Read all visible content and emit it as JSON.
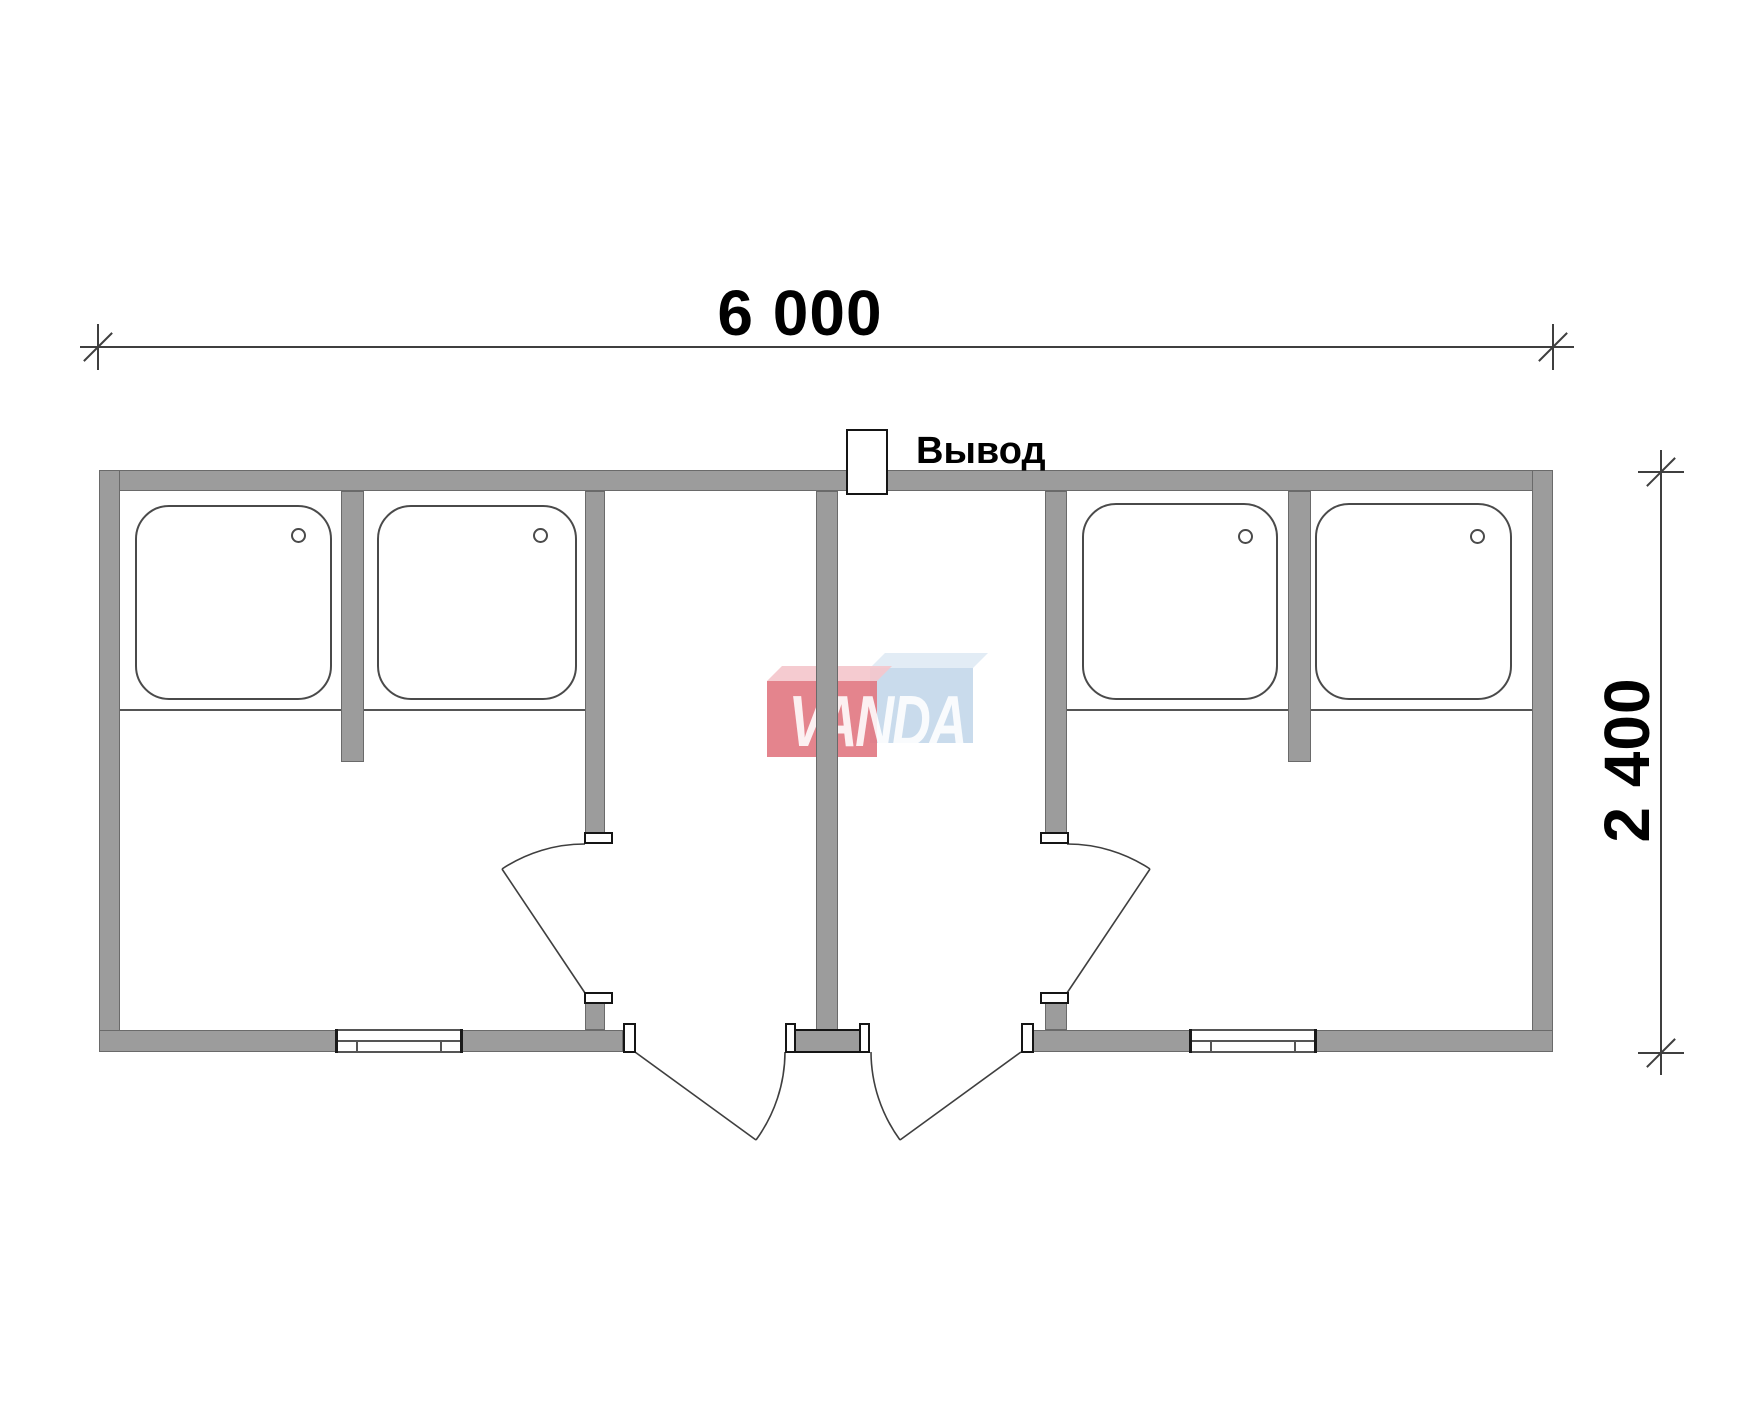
{
  "dimensions": {
    "width_label": "6 000",
    "depth_label": "2 400",
    "width_mm": 6000,
    "depth_mm": 2400
  },
  "annotations": {
    "outlet_label": "Вывод"
  },
  "watermark": {
    "text": "VANDA",
    "red_face": "#e27983",
    "red_bevel": "#f4c7cc",
    "blue_face": "#c4d8ea",
    "blue_bevel": "#dfeaf4",
    "text_color": "#ffffff"
  },
  "colors": {
    "wall_fill": "#9c9c9c",
    "wall_edge": "#6a6a6a",
    "drawing_line": "#3f3f3f",
    "background": "#ffffff"
  },
  "plan": {
    "type": "floor-plan",
    "layout": "mirror-symmetric double shower block: two shower rooms with two shower trays each at the ends, two entrance vestibules in the middle",
    "fixtures": {
      "shower_trays": 4,
      "stall_divider_walls": 2,
      "interior_doors": 2,
      "entrance_doors": 2,
      "windows": 2,
      "roof_outlets": 1
    }
  }
}
